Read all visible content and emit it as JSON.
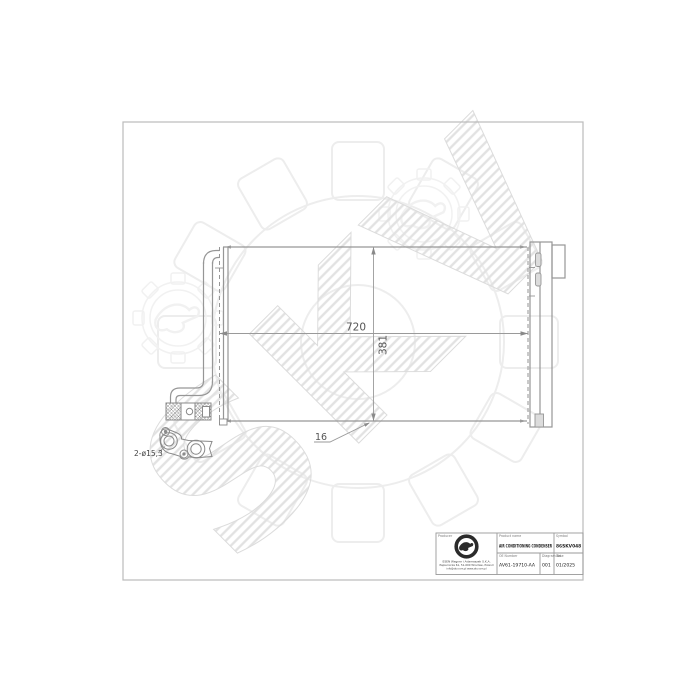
{
  "watermark": {
    "text": "SKV"
  },
  "drawing": {
    "dim_width": "720",
    "dim_height": "381",
    "dim_depth": "16",
    "port_label": "2-ø15,3"
  },
  "title_block": {
    "producer_label": "Producer",
    "product_label": "Product name",
    "product_value": "AIR CONDITIONING CONDENSER",
    "symbol_label": "Symbol",
    "symbol_value": "86SKV048",
    "oe_label": "OE Number",
    "oe_value": "AV61-19710-AA",
    "diagram_label": "Diagram No.",
    "diagram_value": "001",
    "date_label": "Date",
    "date_value": "01/2025",
    "company_line1": "ESEN Wagner i Adamaszek S.K.A.",
    "company_line2": "Papiernicza 61, 51-000 Wrocław, Poland",
    "company_line3": "info@skv.com.pl  www.skv.com.pl"
  },
  "colors": {
    "drawing_line": "#969696",
    "dimension_text": "#555555",
    "watermark_gray": "#e4e4e4",
    "frame_gray": "#bbbbbb",
    "stamp_black": "#2b2b2b"
  }
}
